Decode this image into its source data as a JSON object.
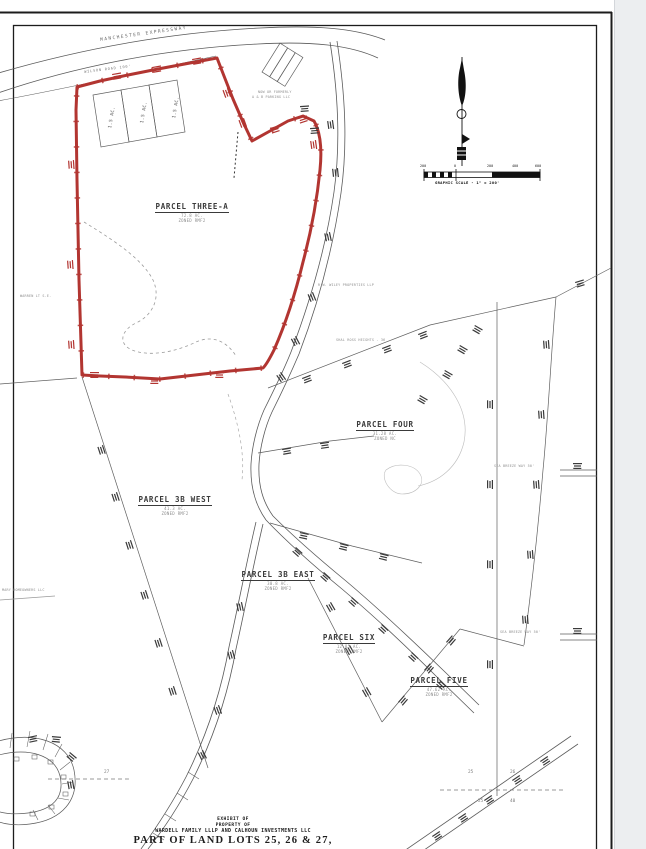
{
  "sheet": {
    "background": "#ffffff",
    "margin_color": "#eceef0",
    "border_color": "#1c1c1c"
  },
  "colors": {
    "parcel_outline_red": "#b23531",
    "linework": "#555555",
    "faint_linework": "#aaaaaa"
  },
  "roads": {
    "manchester": "MANCHESTER EXPRESSWAY",
    "wilson": "WILSON ROAD 100'"
  },
  "small_lots": {
    "label": "1.5 AC."
  },
  "parcels": [
    {
      "name": "PARCEL THREE-A",
      "area": "72.8 AC.",
      "zoned": "ZONED RMF2"
    },
    {
      "name": "PARCEL FOUR",
      "area": "31.28 AC.",
      "zoned": "ZONED NC"
    },
    {
      "name": "PARCEL 3B WEST",
      "area": "41.3 AC.",
      "zoned": "ZONED RMF2"
    },
    {
      "name": "PARCEL 3B EAST",
      "area": "30.8 AC.",
      "zoned": "ZONED RMF2"
    },
    {
      "name": "PARCEL SIX",
      "area": "12.85 AC.",
      "zoned": "ZONED RMF2"
    },
    {
      "name": "PARCEL FIVE",
      "area": "47.62 AC.",
      "zoned": "ZONED RMF2"
    }
  ],
  "owners": [
    {
      "text": "NOW OR FORMERLY"
    },
    {
      "text": "A & B PARKING LLC"
    },
    {
      "text": "R.W. WILEY PROPERTIES LLP"
    },
    {
      "text": "WARREN LT S.E."
    },
    {
      "text": "MARY HOMEOWNERS LLC"
    },
    {
      "text": "SEA BREEZE WAY 50'"
    },
    {
      "text": "SEA BREEZE WAY 50'"
    },
    {
      "text": "SHAL ROSS HEIGHTS - 36"
    }
  ],
  "land_lot_numbers": {
    "values": [
      "25",
      "26",
      "25",
      "40",
      "27"
    ]
  },
  "scale_bar": {
    "ticks": [
      "200",
      "0",
      "200",
      "400",
      "600"
    ],
    "caption": "GRAPHIC SCALE - 1\" = 200'"
  },
  "title_block": {
    "line1": "EXHIBIT OF",
    "line2": "PROPERTY OF",
    "line3": "WARDELL FAMILY LLLP AND CALHOUN INVESTMENTS LLC",
    "line4": "PART OF LAND LOTS 25, 26 & 27,"
  }
}
